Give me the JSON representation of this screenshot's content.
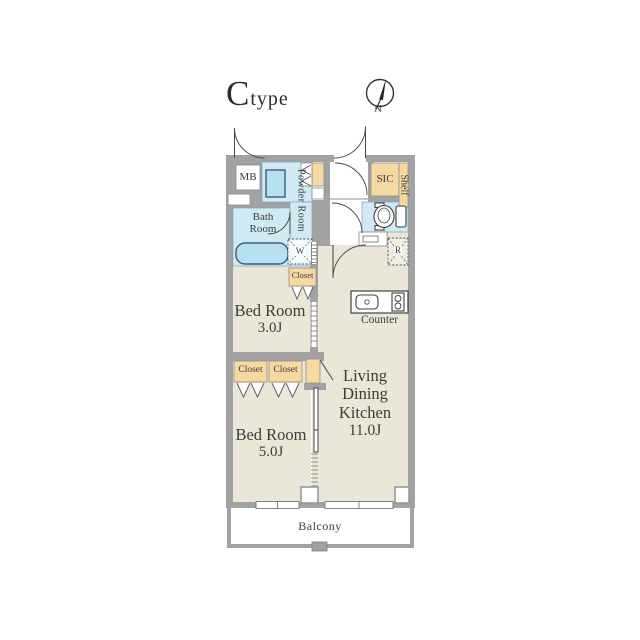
{
  "title": {
    "letter": "C",
    "suffix": "type"
  },
  "compass": {
    "north_label": "N"
  },
  "colors": {
    "wall": "#a2a2a2",
    "room": "#eae6d8",
    "wet": "#cfeaf3",
    "fixture": "#b7e0f0",
    "storage": "#f6d8a0",
    "text": "#3c3c3c"
  },
  "rooms": {
    "ldk": {
      "lines": [
        "Living",
        "Dining",
        "Kitchen"
      ],
      "size": "11.0J"
    },
    "bedroom3": {
      "name": "Bed Room",
      "size": "3.0J"
    },
    "bedroom5": {
      "name": "Bed Room",
      "size": "5.0J"
    },
    "bath": {
      "lines": [
        "Bath",
        "Room"
      ]
    },
    "powder": {
      "label": "Powder Room"
    },
    "balcony": {
      "label": "Balcony"
    }
  },
  "labels": {
    "meter_box": "MB",
    "shoe_closet": "SIC",
    "shelf": "Shelf",
    "washer": "W",
    "refrigerator": "R",
    "counter": "Counter",
    "closet_bedroom3": "Closet",
    "closet_bedroom5_left": "Closet",
    "closet_bedroom5_right": "Closet"
  }
}
